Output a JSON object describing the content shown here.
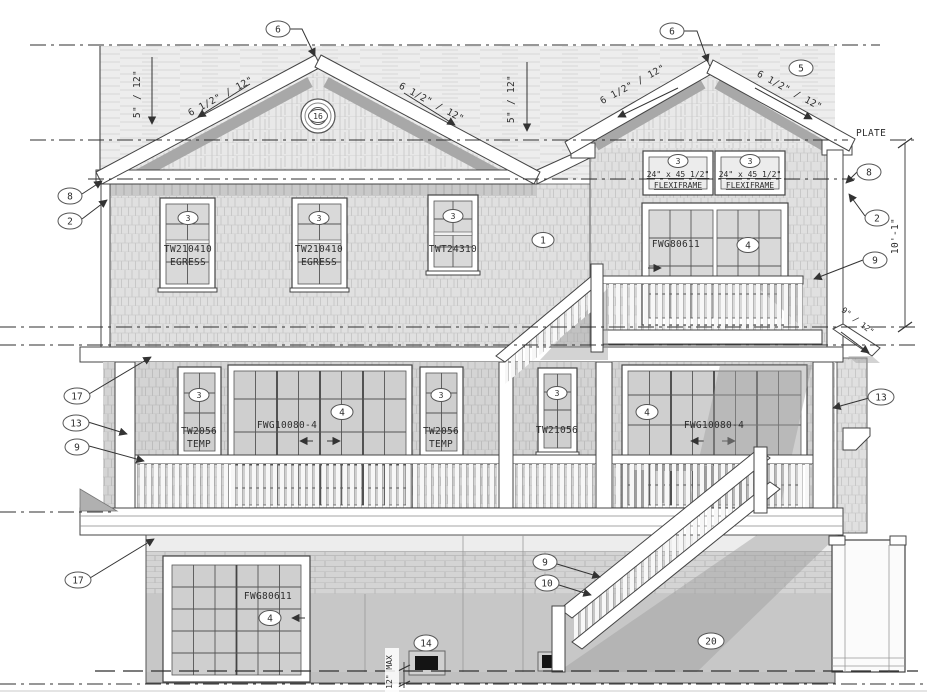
{
  "palette": {
    "ink": "#3c3c3c",
    "paper": "#ffffff",
    "roof": "#ededed",
    "shingle": "#e0e0e0",
    "shadow": "#9e9e9e",
    "glass": "#d9d9d9"
  },
  "annotations": {
    "plate": "PLATE",
    "overall_height": "10'-1\"",
    "vent_height": "12\" MAX",
    "main_roof_slope": "5\" / 12\"",
    "gable_roof_slope": "6 1/2\" / 12\"",
    "shed_roof_slope": "9\" / 12\""
  },
  "callouts": {
    "ridge_left": "6",
    "ridge_right": "6",
    "roof_shingles": "5",
    "gable_vent": "16",
    "eave_left_upper": "8",
    "eave_left_lower": "2",
    "eave_right_upper": "8",
    "eave_right_lower": "2",
    "siding": "1",
    "balcony_rail": "9",
    "porch_trim": "17",
    "porch_corner": "13",
    "porch_rail": "9",
    "porch_corner_right": "13",
    "lower_trim": "17",
    "stair_rail": "9",
    "stair_stringer": "10",
    "crawl_vent": "14",
    "lower_wall": "20"
  },
  "openings": {
    "flexiframe_left": {
      "tag": "3",
      "size": "24\" x 45 1/2\"",
      "name": "FLEXIFRAME"
    },
    "flexiframe_right": {
      "tag": "3",
      "size": "24\" x 45 1/2\"",
      "name": "FLEXIFRAME"
    },
    "egress_left": {
      "tag": "3",
      "code": "TW210410",
      "note": "EGRESS"
    },
    "egress_center": {
      "tag": "3",
      "code": "TW210410",
      "note": "EGRESS"
    },
    "transom_right": {
      "tag": "3",
      "code": "TWT24310"
    },
    "balcony_door": {
      "tag": "4",
      "code": "FWG80611"
    },
    "porch_window_left": {
      "tag": "3",
      "code": "TW2056",
      "note": "TEMP"
    },
    "porch_door_left": {
      "tag": "4",
      "code": "FWG10080-4"
    },
    "porch_window_right": {
      "tag": "3",
      "code": "TW2056",
      "note": "TEMP"
    },
    "center_window": {
      "tag": "3",
      "code": "TW21056"
    },
    "porch_door_right": {
      "tag": "4",
      "code": "FWG10080-4"
    },
    "garage_door": {
      "tag": "4",
      "code": "FWG80611"
    }
  }
}
